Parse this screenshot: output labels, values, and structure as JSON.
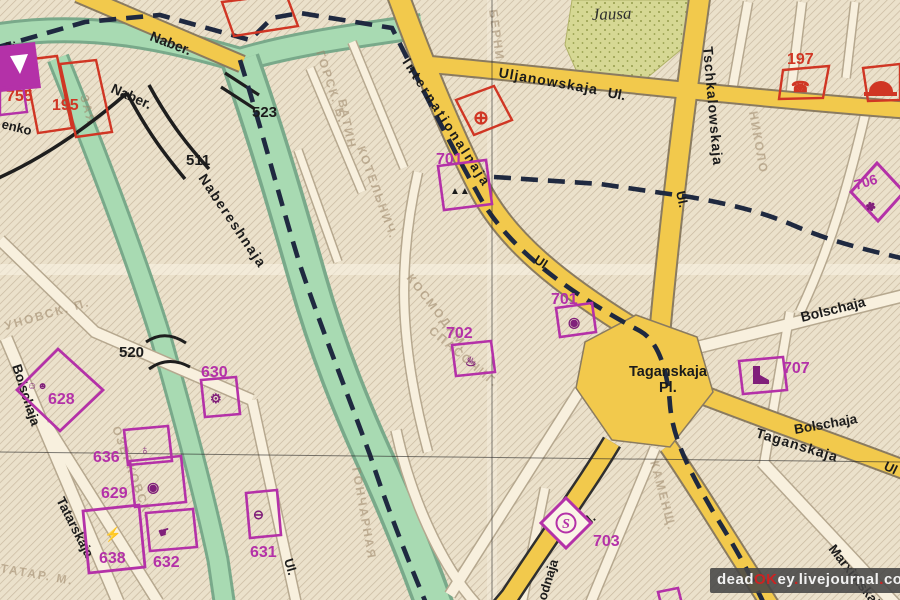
{
  "map_labels": {
    "streets": {
      "naber_top": "Naber.",
      "naber_lower": "Naber.",
      "nabereshnaja": "Nabereshnaja",
      "internationalnaja": "Internationalnaja",
      "internationalnaja_ul": "Ul.",
      "uljanowskaja": "Uljanowskaja",
      "uljanowskaja_ul": "Ul.",
      "tschkalowskaja": "Tschkalowskaja",
      "tschkalowskaja_ul": "Ul.",
      "taganskaja_pl_name": "Taganskaja",
      "taganskaja_pl_abbr": "Pl.",
      "taganskaja_street": "Taganskaja",
      "taganskaja_street_ul": "Ul",
      "bolschaja_right": "Bolschaja",
      "bolschaja_right2": "Bolschaja",
      "bolschaja_left": "Bolschaja",
      "tatarskaja": "Tatarskaja",
      "marxistskaja": "Marxistskaja",
      "wodnaja_fragment": "odnaja",
      "wodnaja_ul": "Ul.",
      "ul_bottom_left": "Ul.",
      "street_fragment_aja": "aja",
      "street_fragment_enko": "enko"
    },
    "water": {
      "jausa": "Jausa"
    },
    "bridge_numbers": {
      "n511": "511",
      "n520": "520",
      "n523": "523"
    },
    "red_numbers": {
      "n755": "755",
      "n195": "195",
      "n197": "197"
    },
    "magenta_numbers": {
      "n628": "628",
      "n629": "629",
      "n630": "630",
      "n631": "631",
      "n632": "632",
      "n636": "636",
      "n638": "638",
      "n701_north": "701",
      "n701_south": "701",
      "n702": "702",
      "n703": "703",
      "n706": "706",
      "n707": "707"
    },
    "station_letter": "S",
    "icons": {
      "telephone": "☎",
      "medical_cross": "⊕",
      "mountains": "▲▲",
      "ringed_dot": "◉",
      "hot_springs": "♨",
      "theater_masks": "☺☻",
      "gear_flower": "⚙",
      "flower": "✽",
      "bomb": "♁",
      "lightning": "⚡",
      "pointing_hand": "☛",
      "circle_bar": "⊖",
      "triangle": "△"
    },
    "faded_underprint": [
      "ГОРСК. Б.",
      "ВАТИН",
      "КОТЕЛЬНИЧ.",
      "КОСМОДАМ.",
      "СПАСОЧИГ.",
      "ГОНЧАРНАЯ",
      "КАМЕНЩ.",
      "НИКОЛО",
      "БЕРНИ",
      "ОЗЕРКОВСК.",
      "ТАТАР. М.",
      "УНОВСК. П.",
      "ЗАЯ"
    ]
  },
  "watermark": {
    "segments": [
      {
        "text": "dead",
        "color": "white"
      },
      {
        "text": "OK",
        "color": "red"
      },
      {
        "text": "ey",
        "color": "white"
      },
      {
        "text": ".",
        "color": "red"
      },
      {
        "text": "livejournal",
        "color": "white"
      },
      {
        "text": ".",
        "color": "red"
      },
      {
        "text": "com",
        "color": "white"
      }
    ]
  },
  "colors": {
    "road_yellow": "#f2c94c",
    "river_green": "#a8dab2",
    "park_green": "#d6d894",
    "overprint_magenta": "#b431a8",
    "overprint_red": "#d03624",
    "boundary_dash": "#1f2940",
    "paper": "#ebe1cb"
  }
}
